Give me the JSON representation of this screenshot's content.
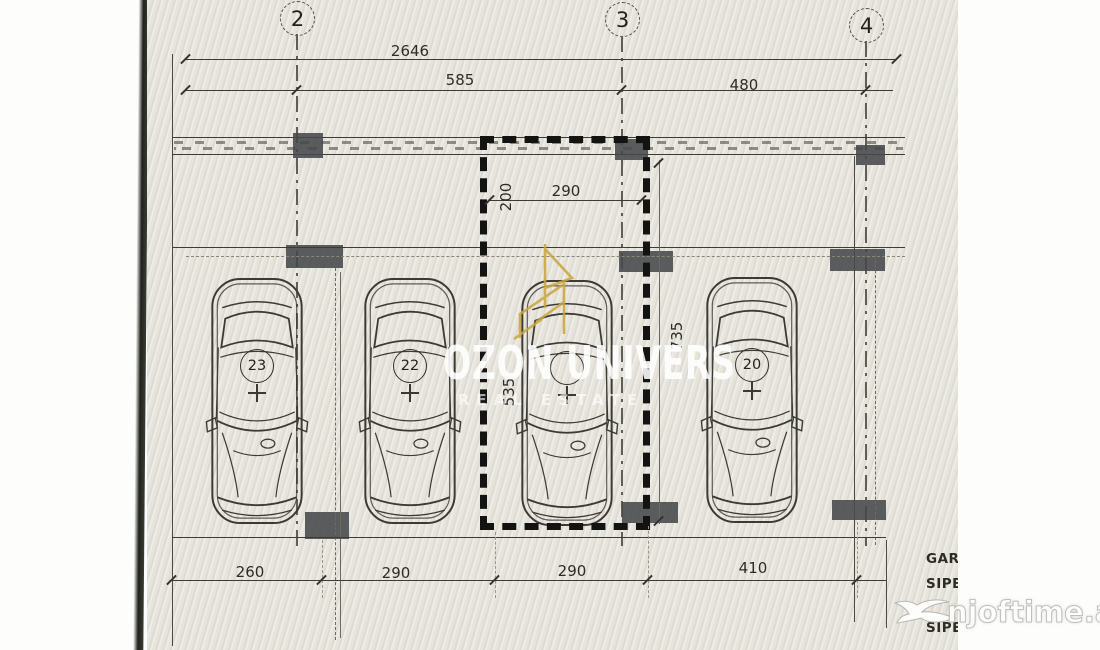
{
  "grid": {
    "bubbles": [
      "2",
      "3",
      "4"
    ]
  },
  "dims": {
    "overall": "2646",
    "top": [
      "585",
      "480"
    ],
    "space_width": "290",
    "space_front_offset": "200",
    "space_length": "535",
    "bay_depth": "735",
    "bottom": [
      "260",
      "290",
      "290",
      "410"
    ]
  },
  "spaces": [
    {
      "number": "23"
    },
    {
      "number": "22"
    },
    {
      "number": ""
    },
    {
      "number": "20"
    }
  ],
  "side_notes": [
    "GARA",
    "SIPE",
    "SIPE"
  ],
  "watermarks": {
    "center_title": "OZON UNIVERS",
    "center_subtitle": "REAL ESTATE",
    "corner": "njoftime.al"
  },
  "colors": {
    "paper": "#e7e4dc",
    "ink": "#3c3b35",
    "column_fill": "#45484a",
    "selection_dash": "#131311",
    "gold": "#c9a53d",
    "watermark_white": "#ffffff"
  }
}
